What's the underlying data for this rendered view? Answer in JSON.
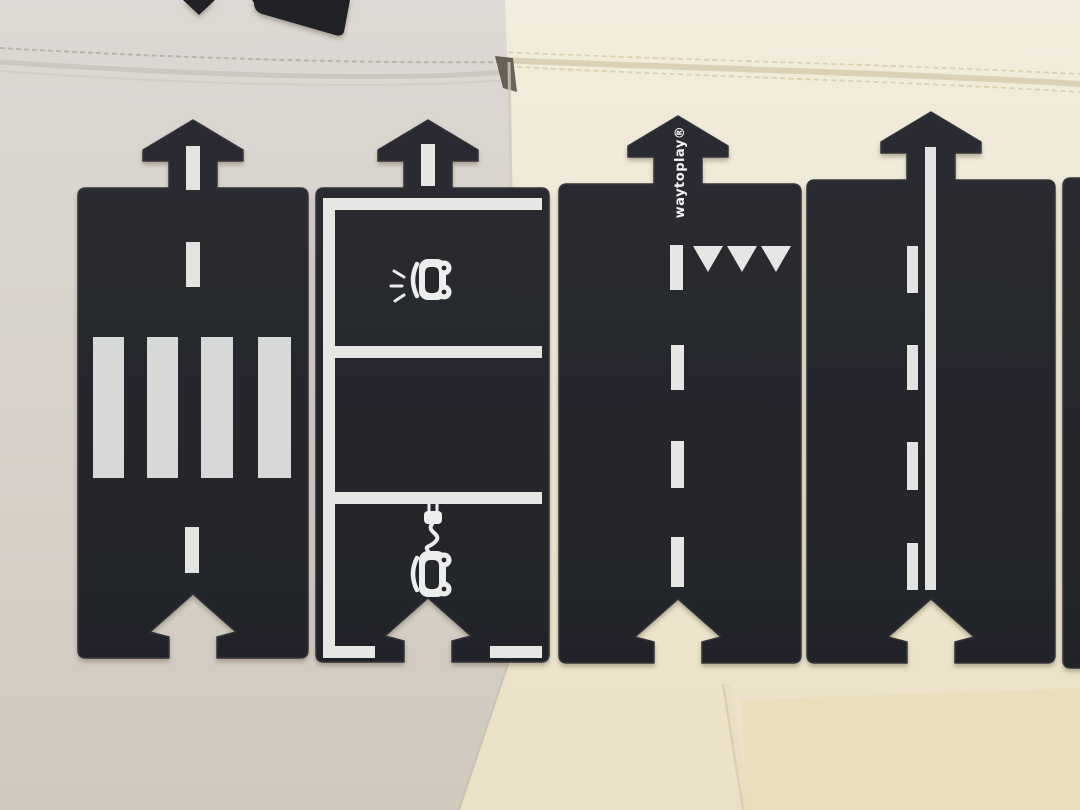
{
  "meta": {
    "type": "photograph",
    "subject": "Black flexible toy road segments (waytoplay) laid out on white and cream leather sofa cushions"
  },
  "brand": {
    "logo_text": "waytoplay®",
    "logo_color": "#f4f4f2"
  },
  "colors": {
    "road_piece_dark": "#27282c",
    "road_marking_white": "#e3e4e2",
    "zebra_stripe_grey": "#d7d9d9",
    "sofa_left_grey_white": "#d8d3cc",
    "sofa_right_cream": "#efe8d5",
    "sofa_seat_yellow_tint": "#e9d9b0",
    "piece_shadow": "#6b5f4c"
  },
  "pieces": [
    {
      "name": "pedestrian-crossing-segment",
      "connector_top": "arrow-tab",
      "connector_bottom": "arrow-notch",
      "markings": {
        "center_dashes": 3,
        "zebra_stripes": 4
      }
    },
    {
      "name": "parking-segment",
      "connector_top": "arrow-tab",
      "connector_bottom": "arrow-notch",
      "markings": {
        "parking_bays": 3,
        "bay_icons": [
          "car-front-with-headlights",
          "electric-car-with-charging-plug"
        ],
        "edge_dashes": 2
      }
    },
    {
      "name": "give-way-segment",
      "connector_top": "arrow-tab",
      "connector_bottom": "arrow-notch",
      "markings": {
        "give_way_triangles": 3,
        "give_way_bar": 1,
        "center_line_dashes": 3,
        "printed_logo": "waytoplay®"
      }
    },
    {
      "name": "two-lane-road-segment",
      "connector_top": "arrow-tab",
      "connector_bottom": "arrow-notch",
      "markings": {
        "solid_edge_line": 1,
        "center_line_dashes": 4
      }
    },
    {
      "name": "partial-road-segment-right-edge",
      "markings": {}
    }
  ],
  "background": {
    "sofa_left": "white-grey leather cushion with stitched seam",
    "sofa_right": "cream leather cushion with double stitched seam",
    "top_edge_objects": "two additional dark road pieces partially visible at top edge"
  }
}
